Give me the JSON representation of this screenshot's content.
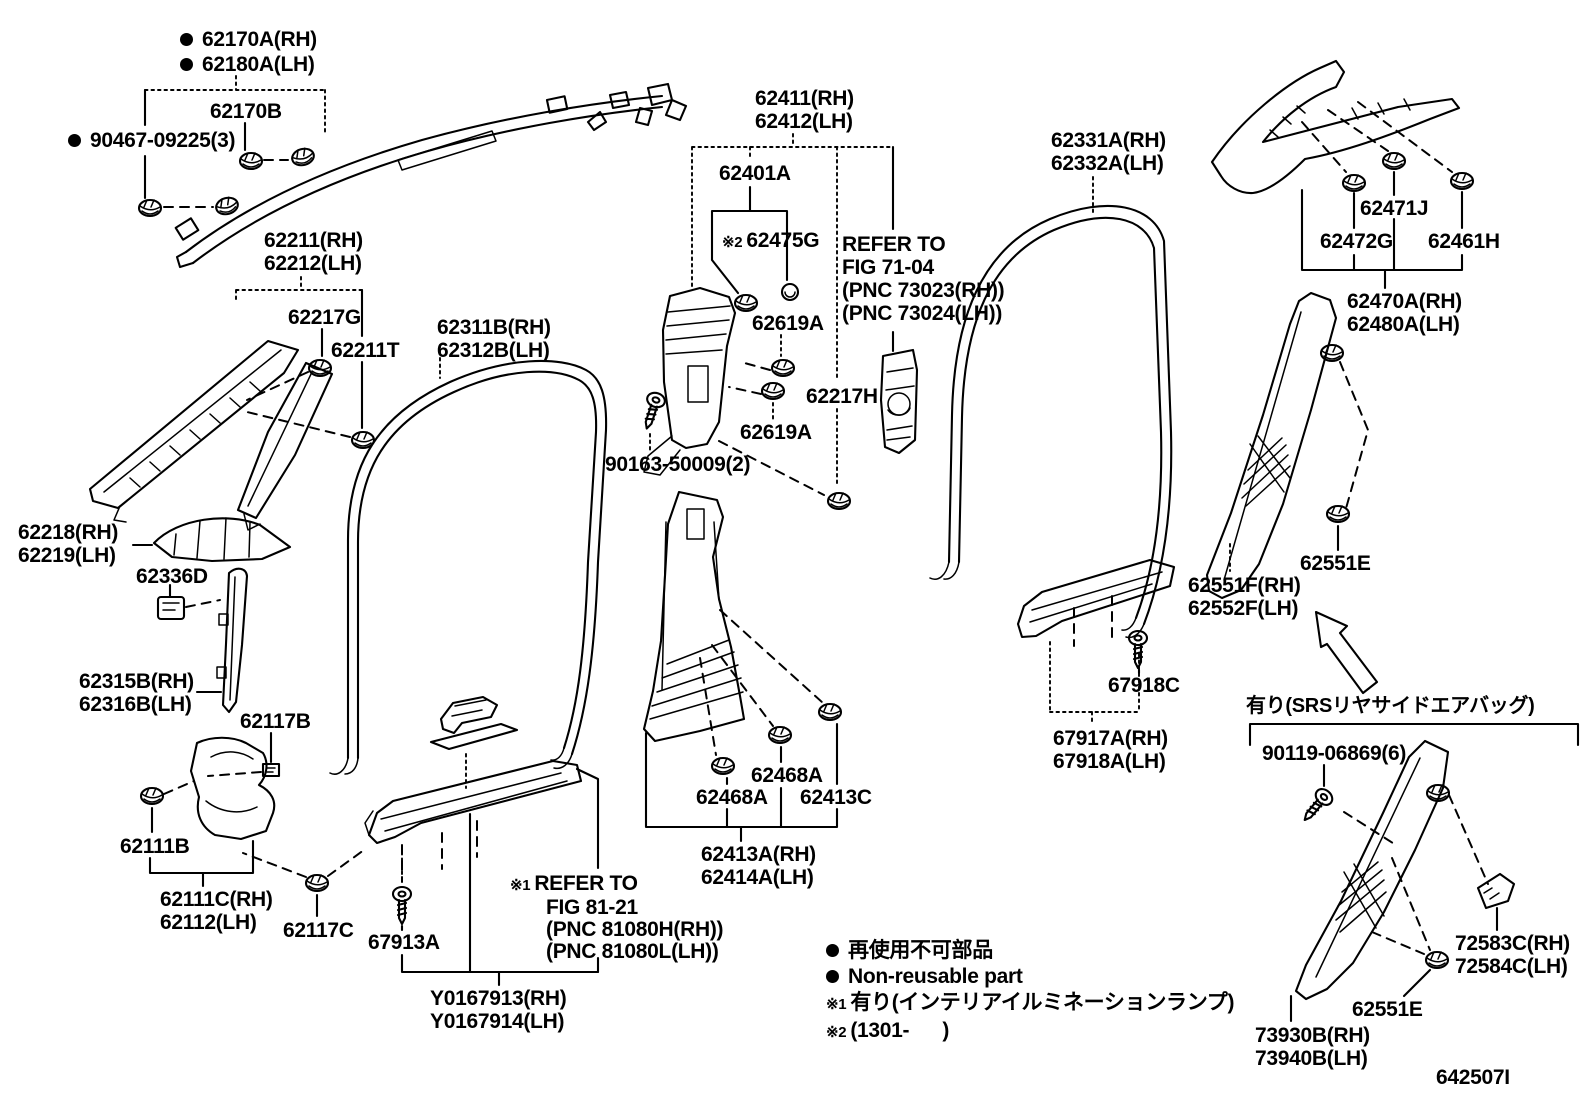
{
  "diagram": {
    "figure_code": "642507I",
    "line_color": "#000000",
    "background_color": "#ffffff",
    "labels": [
      {
        "id": "curtain-airbag",
        "x": 180,
        "y": 27,
        "lh": 25,
        "lines": [
          {
            "bullet": true,
            "text": "62170A(RH)"
          },
          {
            "bullet": true,
            "text": "62180A(LH)"
          }
        ]
      },
      {
        "id": "62170B",
        "x": 210,
        "y": 100,
        "lines": [
          {
            "text": "62170B"
          }
        ]
      },
      {
        "id": "90467-09225",
        "x": 68,
        "y": 129,
        "lines": [
          {
            "bullet": true,
            "text": "90467-09225(3)"
          }
        ]
      },
      {
        "id": "62211",
        "x": 264,
        "y": 229,
        "lines": [
          {
            "text": "62211(RH)"
          },
          {
            "text": "62212(LH)"
          }
        ]
      },
      {
        "id": "62217G",
        "x": 288,
        "y": 306,
        "lines": [
          {
            "text": "62217G"
          }
        ]
      },
      {
        "id": "62211T",
        "x": 331,
        "y": 339,
        "lines": [
          {
            "text": "62211T"
          }
        ]
      },
      {
        "id": "62311B",
        "x": 437,
        "y": 316,
        "lines": [
          {
            "text": "62311B(RH)"
          },
          {
            "text": "62312B(LH)"
          }
        ]
      },
      {
        "id": "62411",
        "x": 755,
        "y": 87,
        "lines": [
          {
            "text": "62411(RH)"
          },
          {
            "text": "62412(LH)"
          }
        ]
      },
      {
        "id": "62401A",
        "x": 719,
        "y": 162,
        "lines": [
          {
            "text": "62401A"
          }
        ]
      },
      {
        "id": "62475G",
        "x": 722,
        "y": 229,
        "lines": [
          {
            "note": "※2",
            "text": "62475G"
          }
        ]
      },
      {
        "id": "refer-fig-71-04",
        "x": 842,
        "y": 233,
        "lh": 23,
        "lines": [
          {
            "text": "REFER TO"
          },
          {
            "text": "FIG 71-04"
          },
          {
            "text": "(PNC 73023(RH))"
          },
          {
            "text": "(PNC 73024(LH))"
          }
        ]
      },
      {
        "id": "62619A-upper",
        "x": 752,
        "y": 312,
        "lines": [
          {
            "text": "62619A"
          }
        ]
      },
      {
        "id": "62217H",
        "x": 806,
        "y": 385,
        "lines": [
          {
            "text": "62217H"
          }
        ]
      },
      {
        "id": "62619A-lower",
        "x": 740,
        "y": 421,
        "lines": [
          {
            "text": "62619A"
          }
        ]
      },
      {
        "id": "90163-50009",
        "x": 605,
        "y": 453,
        "lines": [
          {
            "text": "90163-50009(2)"
          }
        ]
      },
      {
        "id": "62331A",
        "x": 1051,
        "y": 129,
        "lines": [
          {
            "text": "62331A(RH)"
          },
          {
            "text": "62332A(LH)"
          }
        ]
      },
      {
        "id": "62471J",
        "x": 1360,
        "y": 197,
        "lines": [
          {
            "text": "62471J"
          }
        ]
      },
      {
        "id": "62472G",
        "x": 1320,
        "y": 230,
        "lines": [
          {
            "text": "62472G"
          }
        ]
      },
      {
        "id": "62461H",
        "x": 1428,
        "y": 230,
        "lines": [
          {
            "text": "62461H"
          }
        ]
      },
      {
        "id": "62470A",
        "x": 1347,
        "y": 290,
        "lines": [
          {
            "text": "62470A(RH)"
          },
          {
            "text": "62480A(LH)"
          }
        ]
      },
      {
        "id": "62218",
        "x": 18,
        "y": 521,
        "lines": [
          {
            "text": "62218(RH)"
          },
          {
            "text": "62219(LH)"
          }
        ]
      },
      {
        "id": "62336D",
        "x": 136,
        "y": 565,
        "lines": [
          {
            "text": "62336D"
          }
        ]
      },
      {
        "id": "62315B",
        "x": 79,
        "y": 670,
        "lines": [
          {
            "text": "62315B(RH)"
          },
          {
            "text": "62316B(LH)"
          }
        ]
      },
      {
        "id": "62117B",
        "x": 240,
        "y": 710,
        "lines": [
          {
            "text": "62117B"
          }
        ]
      },
      {
        "id": "62111B",
        "x": 120,
        "y": 835,
        "lines": [
          {
            "text": "62111B"
          }
        ]
      },
      {
        "id": "62111C",
        "x": 160,
        "y": 888,
        "lines": [
          {
            "text": "62111C(RH)"
          },
          {
            "text": "62112(LH)"
          }
        ]
      },
      {
        "id": "62117C",
        "x": 283,
        "y": 919,
        "lines": [
          {
            "text": "62117C"
          }
        ]
      },
      {
        "id": "67913A",
        "x": 368,
        "y": 931,
        "lines": [
          {
            "text": "67913A"
          }
        ]
      },
      {
        "id": "Y0167913",
        "x": 430,
        "y": 987,
        "lines": [
          {
            "text": "Y0167913(RH)"
          },
          {
            "text": "Y0167914(LH)"
          }
        ]
      },
      {
        "id": "refer-fig-81-21",
        "x": 510,
        "y": 873,
        "lh": 22,
        "lines": [
          {
            "note": "※1",
            "text": "REFER TO"
          },
          {
            "text": "FIG 81-21",
            "indent": true
          },
          {
            "text": "(PNC 81080H(RH))",
            "indent": true
          },
          {
            "text": "(PNC 81080L(LH))",
            "indent": true
          }
        ]
      },
      {
        "id": "62468A-upper",
        "x": 751,
        "y": 764,
        "lines": [
          {
            "text": "62468A"
          }
        ]
      },
      {
        "id": "62468A-lower",
        "x": 696,
        "y": 786,
        "lines": [
          {
            "text": "62468A"
          }
        ]
      },
      {
        "id": "62413C",
        "x": 800,
        "y": 786,
        "lines": [
          {
            "text": "62413C"
          }
        ]
      },
      {
        "id": "62413A",
        "x": 701,
        "y": 843,
        "lines": [
          {
            "text": "62413A(RH)"
          },
          {
            "text": "62414A(LH)"
          }
        ]
      },
      {
        "id": "67918C",
        "x": 1108,
        "y": 674,
        "lines": [
          {
            "text": "67918C"
          }
        ]
      },
      {
        "id": "67917A",
        "x": 1053,
        "y": 727,
        "lines": [
          {
            "text": "67917A(RH)"
          },
          {
            "text": "67918A(LH)"
          }
        ]
      },
      {
        "id": "62551F",
        "x": 1188,
        "y": 574,
        "lines": [
          {
            "text": "62551F(RH)"
          },
          {
            "text": "62552F(LH)"
          }
        ]
      },
      {
        "id": "62551E-upper",
        "x": 1300,
        "y": 552,
        "lines": [
          {
            "text": "62551E"
          }
        ]
      },
      {
        "id": "srs-airbag-note",
        "x": 1246,
        "y": 695,
        "size": 20,
        "lines": [
          {
            "text": "有り(SRSリヤサイドエアバッグ)"
          }
        ]
      },
      {
        "id": "90119-06869",
        "x": 1262,
        "y": 742,
        "lines": [
          {
            "text": "90119-06869(6)"
          }
        ]
      },
      {
        "id": "72583C",
        "x": 1455,
        "y": 932,
        "lines": [
          {
            "text": "72583C(RH)"
          },
          {
            "text": "72584C(LH)"
          }
        ]
      },
      {
        "id": "62551E-lower",
        "x": 1352,
        "y": 998,
        "lines": [
          {
            "text": "62551E"
          }
        ]
      },
      {
        "id": "73930B",
        "x": 1255,
        "y": 1024,
        "lines": [
          {
            "text": "73930B(RH)"
          },
          {
            "text": "73940B(LH)"
          }
        ]
      },
      {
        "id": "legend",
        "x": 826,
        "y": 938,
        "lh": 26,
        "lines": [
          {
            "bullet": true,
            "text": "再使用不可部品"
          },
          {
            "bullet": true,
            "text": "Non-reusable part"
          },
          {
            "note": "※1",
            "text": "有り(インテリアイルミネーションランプ)"
          },
          {
            "note": "※2",
            "text": "(1301-      )"
          }
        ]
      },
      {
        "id": "figure-code",
        "x": 1436,
        "y": 1066,
        "lines": [
          {
            "text": "642507I"
          }
        ]
      }
    ]
  }
}
